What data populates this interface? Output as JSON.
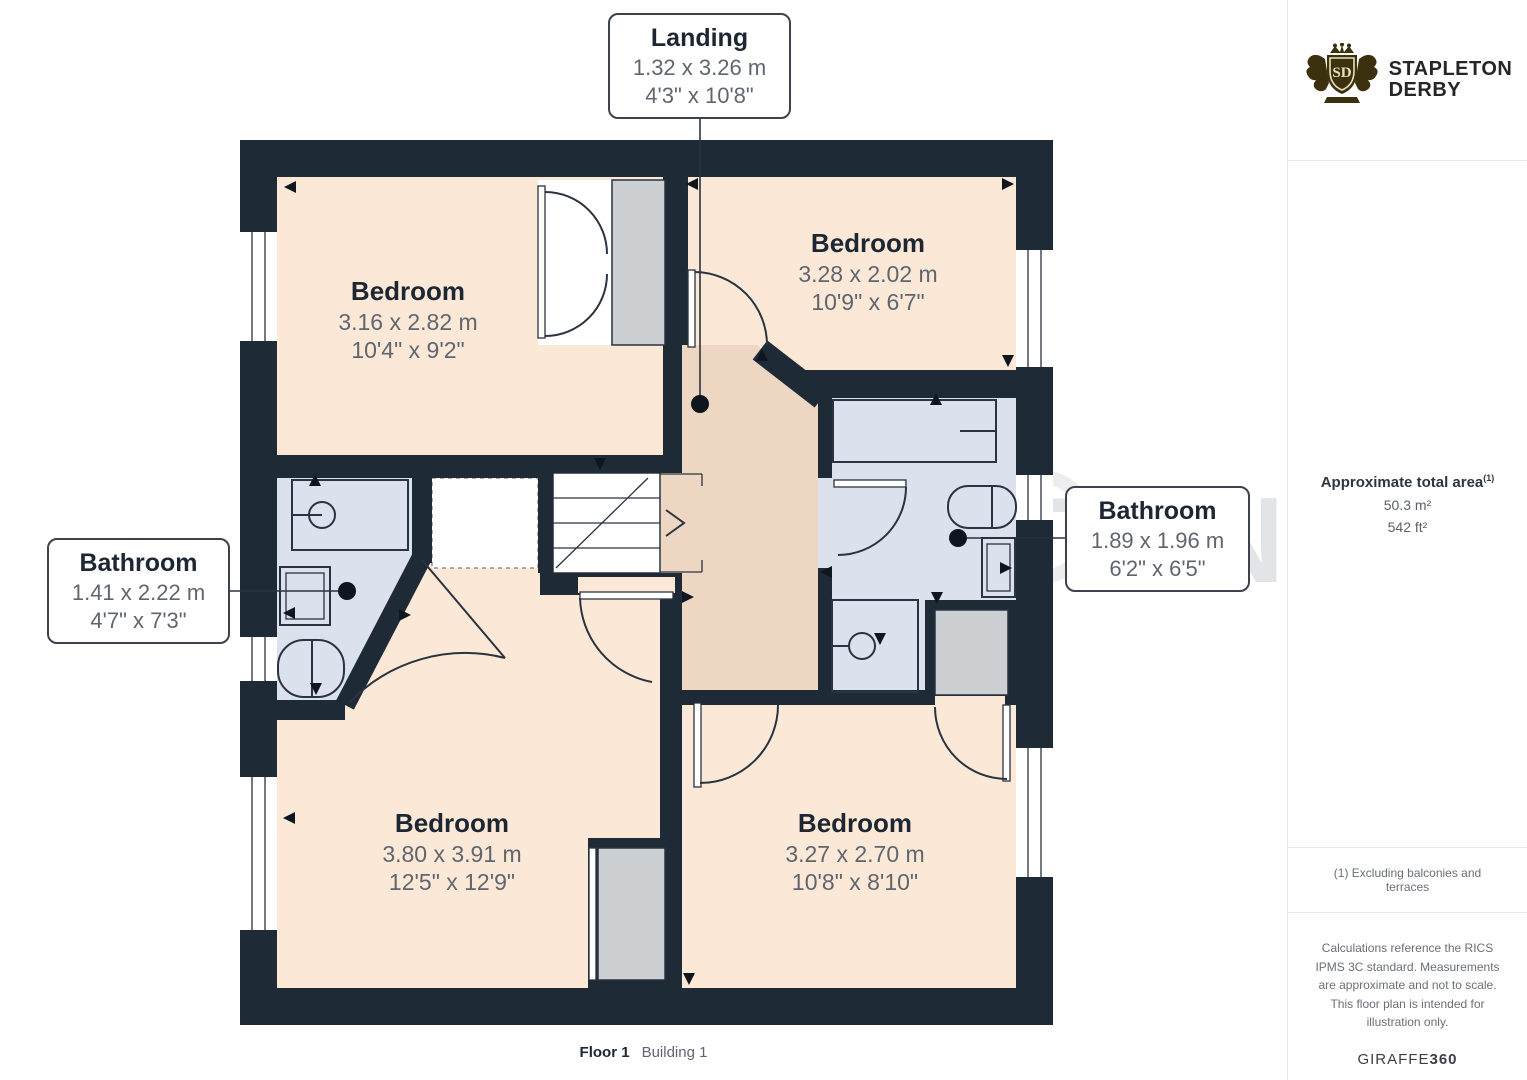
{
  "watermark": {
    "line1": "STAPLETON",
    "line2": "DERBY",
    "monogram": "SD"
  },
  "logo": {
    "brand_line1": "STAPLETON",
    "brand_line2": "DERBY",
    "monogram": "SD"
  },
  "rooms": [
    {
      "name": "Bedroom",
      "metric": "3.16 x 2.82 m",
      "imperial": "10'4\" x 9'2\""
    },
    {
      "name": "Bedroom",
      "metric": "3.28 x 2.02 m",
      "imperial": "10'9\" x 6'7\""
    },
    {
      "name": "Bedroom",
      "metric": "3.80 x 3.91 m",
      "imperial": "12'5\" x 12'9\""
    },
    {
      "name": "Bedroom",
      "metric": "3.27 x 2.70 m",
      "imperial": "10'8\" x 8'10\""
    }
  ],
  "callouts": [
    {
      "name": "Landing",
      "metric": "1.32 x 3.26 m",
      "imperial": "4'3\" x 10'8\""
    },
    {
      "name": "Bathroom",
      "metric": "1.41 x 2.22 m",
      "imperial": "4'7\" x 7'3\""
    },
    {
      "name": "Bathroom",
      "metric": "1.89 x 1.96 m",
      "imperial": "6'2\" x 6'5\""
    }
  ],
  "sidebar": {
    "area_title": "Approximate total area",
    "area_footnote_marker": "(1)",
    "area_m2": "50.3 m²",
    "area_ft2": "542 ft²",
    "footnote": "(1) Excluding balconies and terraces",
    "disclaimer": "Calculations reference the RICS IPMS 3C standard. Measurements are approximate and not to scale. This floor plan is intended for illustration only.",
    "credit_regular": "GIRAFFE",
    "credit_bold": "360"
  },
  "caption": {
    "floor": "Floor 1",
    "building": "Building 1"
  },
  "colors": {
    "wall": "#1f2a37",
    "room_fill": "#fce8d6",
    "landing_fill": "#eed7c2",
    "bathroom_fill": "#dce2ed",
    "closet_fill": "#cdd0d3",
    "logo_gold": "#3d300e",
    "text_dark": "#1d2733",
    "text_gray": "#5f6670"
  }
}
